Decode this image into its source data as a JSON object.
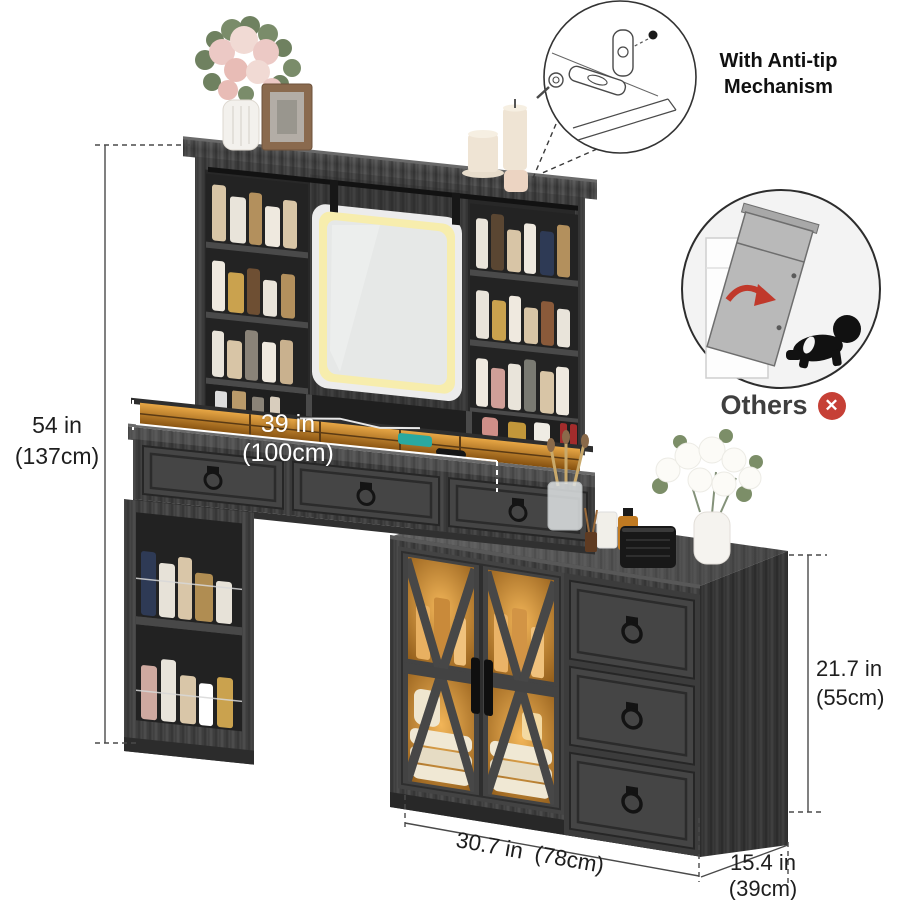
{
  "callout_anti_tip": {
    "line1": "With Anti-tip",
    "line2": "Mechanism",
    "icon": "anti-tip-bracket-illustration"
  },
  "callout_others": {
    "label": "Others",
    "x_icon_glyph": "✕",
    "icon": "tipping-dresser-child-illustration"
  },
  "dimensions": {
    "total_height": {
      "inches": "54 in",
      "metric": "(137cm)"
    },
    "desktop_width": {
      "inches": "39 in",
      "metric": "(100cm)"
    },
    "side_cabinet_height": {
      "inches": "21.7 in",
      "metric": "(55cm)"
    },
    "side_cabinet_width": {
      "inches": "30.7 in",
      "metric": "(78cm)"
    },
    "side_cabinet_depth": {
      "inches": "15.4 in",
      "metric": "(39cm)"
    }
  },
  "colors": {
    "wood": "#3f3f3f",
    "wood_dark": "#2a2a2a",
    "mirror_led": "#f7edad",
    "cabinet_glow": "#c07a22",
    "dimension_line": "#4a4a4a",
    "alert_red": "#c64036"
  }
}
